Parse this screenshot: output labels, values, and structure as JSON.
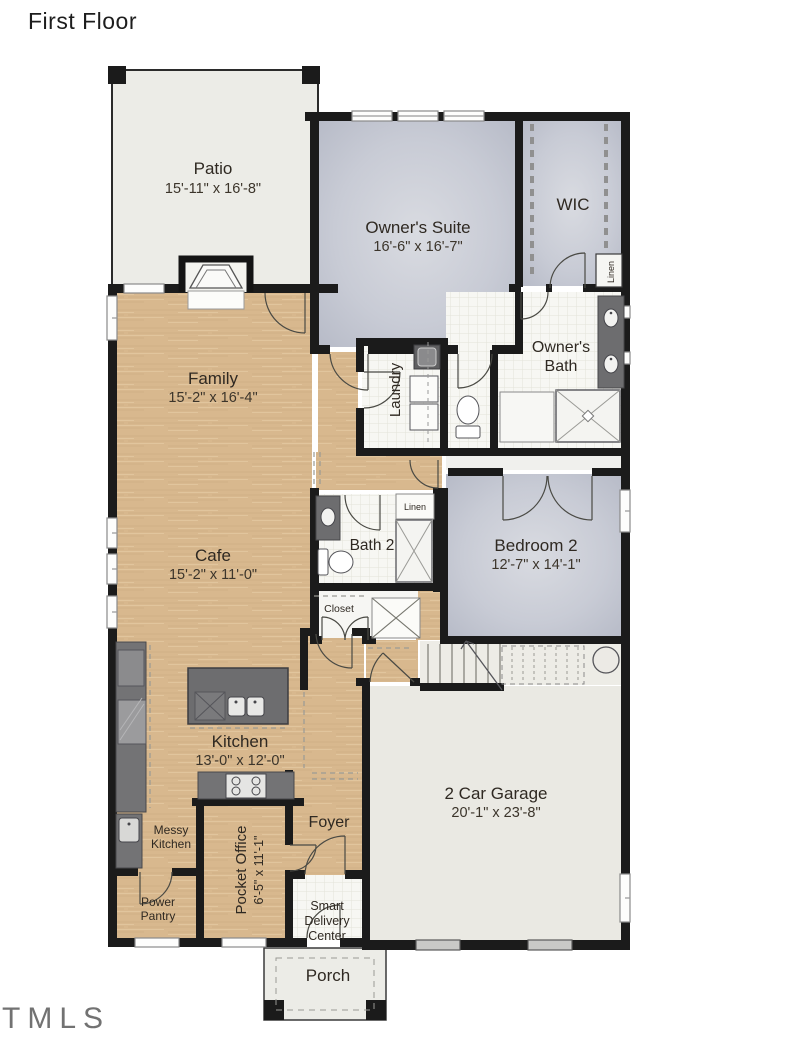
{
  "title": "First Floor",
  "watermark": "TMLS",
  "colors": {
    "wall": "#1b1b1b",
    "wood_floor": "#d8b88e",
    "suite_floor": "#c8cbd5",
    "tile_floor": "#f7f7f3",
    "garage_floor": "#eae9e3",
    "counter": "#737375",
    "label_text": "#2f2922"
  },
  "rooms": {
    "patio": {
      "name": "Patio",
      "dims": "15'-11\" x 16'-8\""
    },
    "owners_suite": {
      "name": "Owner's Suite",
      "dims": "16'-6\" x 16'-7\""
    },
    "wic": {
      "name": "WIC"
    },
    "linen_wic": {
      "name": "Linen"
    },
    "owners_bath": {
      "line1": "Owner's",
      "line2": "Bath"
    },
    "laundry": {
      "name": "Laundry"
    },
    "family": {
      "name": "Family",
      "dims": "15'-2\" x 16'-4\""
    },
    "cafe": {
      "name": "Cafe",
      "dims": "15'-2\" x 11'-0\""
    },
    "bath2": {
      "name": "Bath 2"
    },
    "linen_bath2": {
      "name": "Linen"
    },
    "closet": {
      "name": "Closet"
    },
    "bedroom2": {
      "name": "Bedroom 2",
      "dims": "12'-7\" x 14'-1\""
    },
    "kitchen": {
      "name": "Kitchen",
      "dims": "13'-0\" x 12'-0\""
    },
    "garage": {
      "name": "2 Car Garage",
      "dims": "20'-1\" x 23'-8\""
    },
    "messy_kitchen": {
      "line1": "Messy",
      "line2": "Kitchen"
    },
    "power_pantry": {
      "line1": "Power",
      "line2": "Pantry"
    },
    "pocket_office": {
      "name": "Pocket Office",
      "dims": "6'-5\" x 11'-1\""
    },
    "smart_delivery": {
      "line1": "Smart",
      "line2": "Delivery",
      "line3": "Center"
    },
    "foyer": {
      "name": "Foyer"
    },
    "porch": {
      "name": "Porch"
    }
  }
}
